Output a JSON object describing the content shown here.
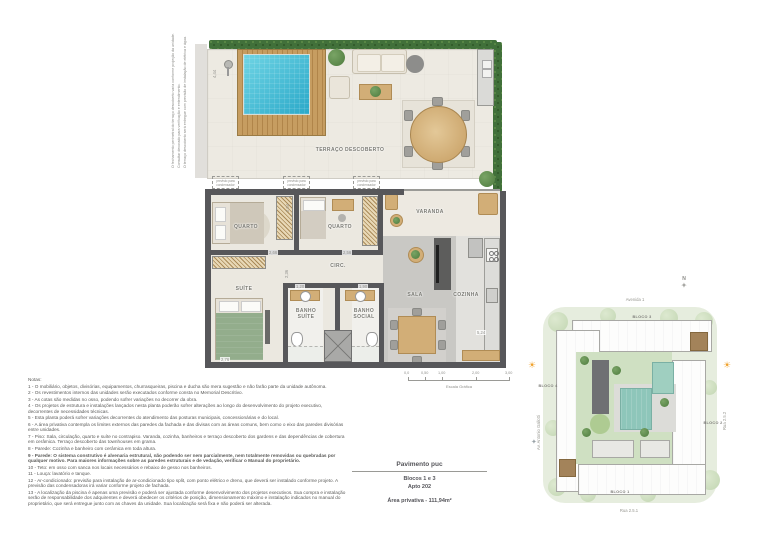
{
  "plan": {
    "rooms": {
      "terraco": "TERRAÇO DESCOBERTO",
      "varanda": "VARANDA",
      "quarto": "QUARTO",
      "suite": "SUÍTE",
      "banho_suite": "BANHO SUÍTE",
      "banho_social": "BANHO SOCIAL",
      "circ": "CIRC.",
      "sala": "SALA",
      "cozinha": "COZINHA"
    },
    "annotations": {
      "side_a": "O fechamento perimetral do terraço descoberto varia conforme projeção da unidade.",
      "side_b": "Consultar decorado para verificação e entendimento.",
      "side_c": "O terraço descoberto será entregue com previsão de instalação de elétrica e água.",
      "condenser": "previsto para condensador"
    },
    "dimensions": {
      "terrace_left": "4,44",
      "quarto1_w": "2,66",
      "quarto2_w": "2,56",
      "quarto1_d": "2,04",
      "suite_d": "2,36",
      "banho_suite_w": "1,20",
      "banho_social_w": "1,90",
      "suite_w": "2,76",
      "cozinha_h": "5,24"
    },
    "scale": {
      "ticks": [
        "0,0",
        "0,50",
        "1,00",
        "2,00",
        "3,00"
      ],
      "label": "Escala Gráfica"
    }
  },
  "notes": {
    "title": "Notas:",
    "items": [
      "1 - O mobiliário, objetos, divisórias, equipamentos, churrasqueiras, piscina e ducha são mera sugestão e não farão parte da unidade autônoma.",
      "2 - Os revestimentos internos das unidades serão executados conforme consta no Memorial Descritivo.",
      "3 - As cotas são medidas no osso, podendo sofrer variações no decorrer da obra.",
      "4 - Os projetos de estrutura e instalações lançados nesta planta poderão sofrer alterações ao longo do desenvolvimento do projeto executivo, decorrentes de necessidades técnicas.",
      "5 - Esta planta poderá sofrer variações decorrentes do atendimento das posturas municipais, concessionárias e do local.",
      "6 - A área privativa contempla os limites externos das paredes da fachada e das divisas com as áreas comuns, bem como o eixo das paredes divisórias entre unidades.",
      "7 - Piso: Sala, circulação, quarto e suíte no contrapiso. Varanda, cozinha, banheiros e terraço descoberto dos gardens e das dependências de cobertura em cerâmica. Terraço descoberto das townhouses em grama.",
      "8 - Parede: Cozinha e banheiro com cerâmica em toda altura.",
      "9 - Parede: O sistema construtivo é alvenaria estrutural, não podendo ser nem parcialmente, nem totalmente removidas ou quebradas por qualquer motivo. Para maiores informações sobre as paredes estruturais e de vedação, verificar o Manual do proprietário.",
      "10 - Teto: em osso com sanca nos locais necessários e rebaixo de gesso nos banheiros.",
      "11 - Louça: lavatório e tanque.",
      "12 - Ar-condicionado: previsão para instalação de ar-condicionado tipo split, com ponto elétrico e dreno, que deverá ser instalado conforme projeto. A previsão das condensadoras irá variar conforme projeto de fachada.",
      "13 - A localização da piscina é apenas uma previsão e poderá ser ajustada conforme desenvolvimento dos projetos executivos. Sua compra e instalação serão de responsabilidade dos adquirentes e deverá obedecer os critérios de posição, dimensionamento máximo e instalação indicados no manual do proprietário, que será entregue junto com as chaves da unidade. Sua localização será fixa e não poderá ser alterada."
    ]
  },
  "title_block": {
    "pavimento": "Pavimento puc",
    "blocos": "Blocos 1 e 3",
    "apto": "Apto 202",
    "area": "Área privativa - 111,94m²"
  },
  "siteplan": {
    "north_label": "N",
    "streets": {
      "top": "Avenida 1",
      "left": "Av. Antonio Gallotti",
      "right": "Rua 2.5.2",
      "bottom": "Rua 2.5.1"
    },
    "blocks": {
      "b1": "BLOCO 1",
      "b2": "BLOCO 2",
      "b3": "BLOCO 3",
      "b4": "BLOCO 4"
    }
  },
  "icons": {
    "sun": "☀",
    "compass_star": "✦",
    "windrose": "✦"
  },
  "colors": {
    "pool": "#35b3d2",
    "deck_wood": "#c69d61",
    "hedge": "#41703a",
    "wall": "#58585a",
    "furniture_wood": "#d2ae77",
    "sala_floor": "#c9c8c4",
    "site_green": "#e6edde",
    "site_pool": "#8ec6ba",
    "unit_highlight": "#a3835a"
  }
}
